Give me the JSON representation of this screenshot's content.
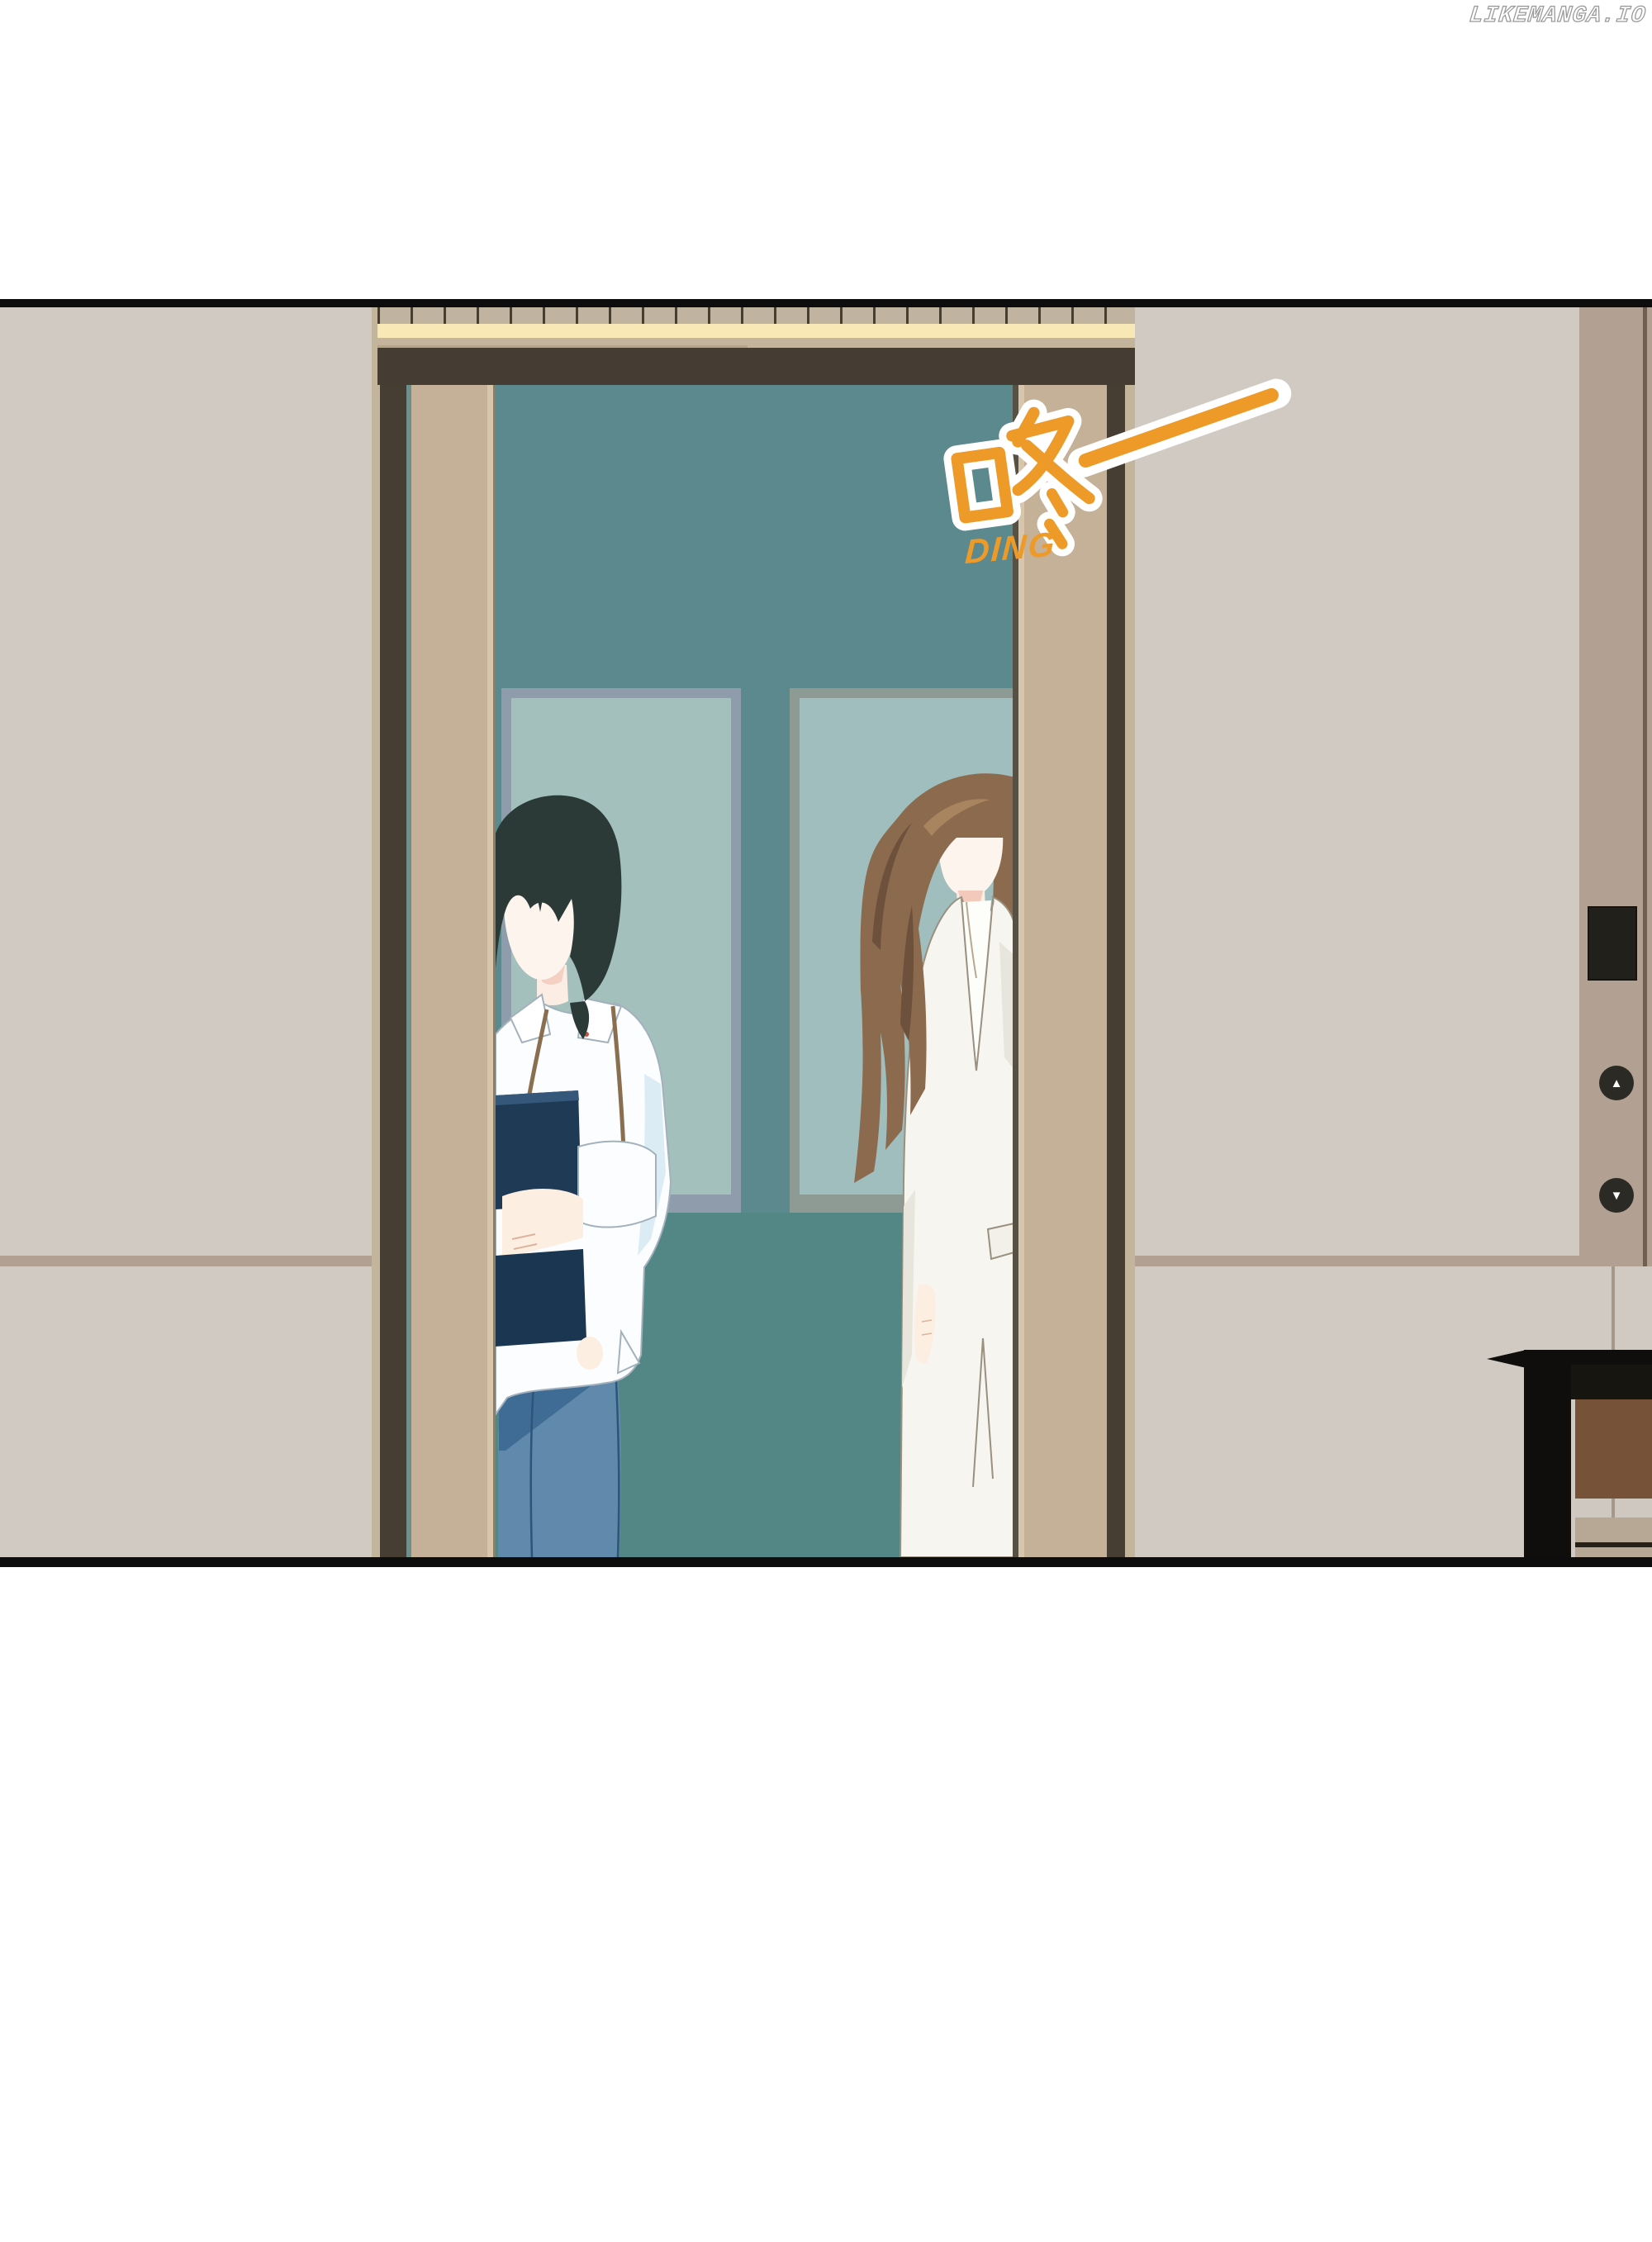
{
  "watermark": {
    "text": "LIKEMANGA.IO"
  },
  "sfx": {
    "main_text": "咚——",
    "sub_text": "DING",
    "color": "#ee9a28",
    "outline_color": "#ffffff"
  },
  "elevator_call_panel": {
    "display_value": "",
    "up_button_glyph": "▲",
    "down_button_glyph": "▼",
    "button_color": "#2b2a25",
    "strip_color": "#b2a192"
  },
  "scene": {
    "type": "manga-panel",
    "setting": "elevator with doors open, two figures inside, hallway walls and side desk",
    "figures": [
      {
        "id": "man-left",
        "hair_color": "#2b3a37",
        "shirt_color": "#fbfdfe",
        "jeans_color": "#6089ac",
        "folder_color": "#1e3a54",
        "lanyard_color": "#8a6e50"
      },
      {
        "id": "woman-right",
        "hair_color": "#8c6a4e",
        "blazer_color": "#f7f5f0",
        "skirt_color": "#f1eee6"
      }
    ]
  },
  "palette": {
    "page_background": "#ffffff",
    "panel_border": "#0d0d0d",
    "wall": "#d1cac2",
    "wall_seam": "#b2a193",
    "door_tan": "#c5b197",
    "door_frame_dark": "#473e33",
    "lintel_yellow": "#f8e8b5",
    "interior_teal_upper": "#5b898d",
    "interior_teal_lower": "#528786",
    "mirror_glass_left": "#a3c0bc",
    "mirror_glass_right": "#a0bebd",
    "accent_orange": "#ee9a28"
  }
}
